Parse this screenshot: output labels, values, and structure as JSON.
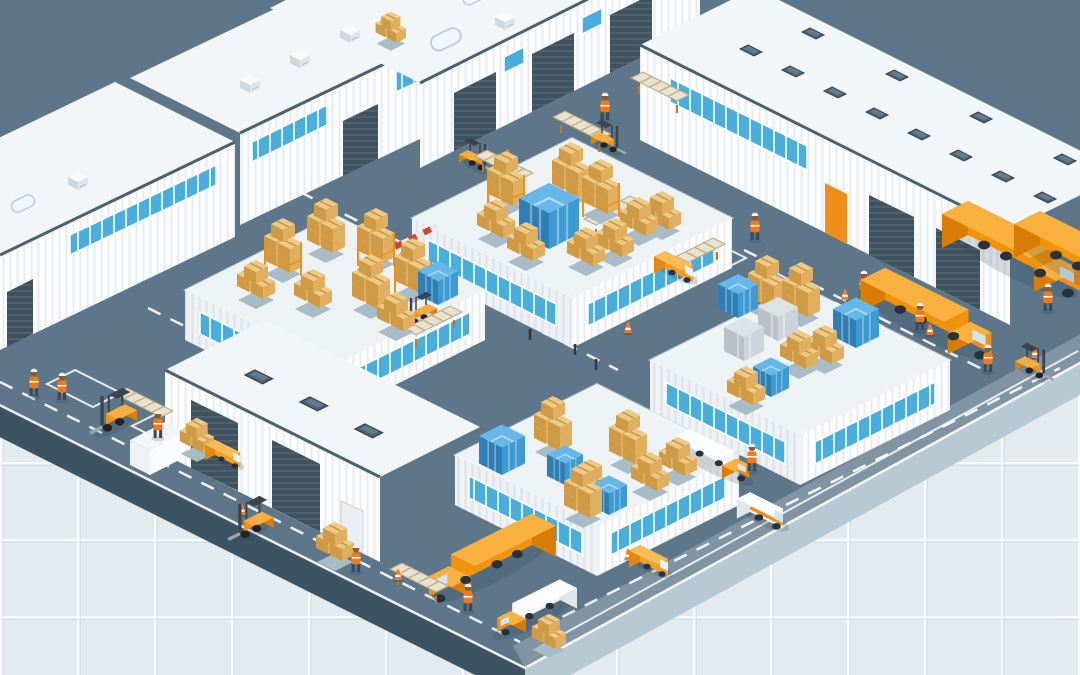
{
  "canvas": {
    "w": 1080,
    "h": 675
  },
  "scene": {
    "description": "Isometric illustration of a logistics park on a pale blue grid: white ribbed warehouse buildings with loading docks and rooftop units, four raised storage yards with blue-glazed walls stacked with tan carton pallets and blue or gray shrink-wrapped pallets, slate roads with white lane markings, orange semi trucks, white box trucks, small vans, forklifts with conveyor ramps, hi-vis workers and traffic cones.",
    "inventory": {
      "warehouse_buildings": 6,
      "storage_yards": 4,
      "orange_trucks": 4,
      "white_trucks": 2,
      "small_vans": 4,
      "forklifts": 6,
      "workers": 12,
      "traffic_cones": 8,
      "pallet_stacks": 42,
      "conveyor_ramps": 8,
      "roof_skylights": 15,
      "bollards": 3
    }
  },
  "palette": {
    "bg": "#e3ebee",
    "road": "#5d7689",
    "slab_left": "#3c5363",
    "slab_right": "#b7c9d3",
    "wall": "#fbfcfd",
    "wall_shade": "#eef2f5",
    "roof": "#f3f6f8",
    "trim": "#4a616f",
    "glass": "#49aede",
    "door": "#3f5260",
    "yard": "#edf2f5",
    "box_top": "#eec984",
    "box_side": "#dfaf5f",
    "box_dark": "#cf9a45",
    "box_tape": "#c89040",
    "wrap_blue_top": "#66b8e8",
    "wrap_blue": "#3d9ad2",
    "wrap_blue_dark": "#2f7fb5",
    "gray_top": "#dde2e6",
    "gray_side": "#cdd3d9",
    "gray_dark": "#b9c0c8",
    "truck_top": "#f8b13f",
    "truck_side": "#f0930c",
    "truck_dark": "#d97c06",
    "white_top": "#fbfdfe",
    "white_side": "#f4f7f9",
    "white_dark": "#dfe7ec",
    "accent": "#ef8f1a",
    "vest": "#f07818",
    "cone": "#f07d28",
    "wheel": "#27333c",
    "shadow": "rgba(40,60,75,0.18)",
    "marking": "#ffffff"
  },
  "sprites": [
    {
      "t": "sky",
      "x": 748,
      "y": 45
    },
    {
      "t": "sky",
      "x": 790,
      "y": 66
    },
    {
      "t": "sky",
      "x": 832,
      "y": 87
    },
    {
      "t": "sky",
      "x": 874,
      "y": 108
    },
    {
      "t": "sky",
      "x": 916,
      "y": 129
    },
    {
      "t": "sky",
      "x": 958,
      "y": 150
    },
    {
      "t": "sky",
      "x": 1000,
      "y": 171
    },
    {
      "t": "sky",
      "x": 1042,
      "y": 192
    },
    {
      "t": "sky",
      "x": 810,
      "y": 28
    },
    {
      "t": "sky",
      "x": 894,
      "y": 70
    },
    {
      "t": "sky",
      "x": 978,
      "y": 112
    },
    {
      "t": "sky",
      "x": 1062,
      "y": 154
    },
    {
      "t": "sky",
      "x": 255,
      "y": 370,
      "s": 1.25
    },
    {
      "t": "sky",
      "x": 310,
      "y": 397,
      "s": 1.25
    },
    {
      "t": "sky",
      "x": 365,
      "y": 424,
      "s": 1.25
    },
    {
      "t": "tank",
      "x": 30,
      "y": 218
    },
    {
      "t": "hvac",
      "x": 78,
      "y": 192
    },
    {
      "t": "hvac",
      "x": 250,
      "y": 95
    },
    {
      "t": "hvac",
      "x": 300,
      "y": 70
    },
    {
      "t": "hvac",
      "x": 350,
      "y": 45
    },
    {
      "t": "tan",
      "x": 390,
      "y": 42,
      "s": 0.8
    },
    {
      "t": "tank",
      "x": 455,
      "y": 58,
      "s": 1.3
    },
    {
      "t": "hvac",
      "x": 505,
      "y": 32
    },
    {
      "t": "tank",
      "x": 480,
      "y": 10,
      "s": 0.9
    },
    {
      "t": "hvac",
      "x": 558,
      "y": -2,
      "s": 0.9
    },
    {
      "t": "conv",
      "x": 475,
      "y": 162
    },
    {
      "t": "conv",
      "x": 553,
      "y": 123
    },
    {
      "t": "conv",
      "x": 631,
      "y": 84
    },
    {
      "t": "conv",
      "x": 642,
      "y": 208,
      "f": 1
    },
    {
      "t": "conv",
      "x": 725,
      "y": 250,
      "f": 1
    },
    {
      "t": "conv",
      "x": 462,
      "y": 318,
      "f": 1
    },
    {
      "t": "conv",
      "x": 115,
      "y": 400
    },
    {
      "t": "conv",
      "x": 390,
      "y": 575
    },
    {
      "t": "rack",
      "x": 505,
      "y": 205
    },
    {
      "t": "tanT",
      "x": 570,
      "y": 196
    },
    {
      "t": "rack",
      "x": 600,
      "y": 213
    },
    {
      "t": "tan",
      "x": 638,
      "y": 235
    },
    {
      "t": "blue",
      "x": 549,
      "y": 249,
      "s": 1.5
    },
    {
      "t": "tan",
      "x": 495,
      "y": 237
    },
    {
      "t": "tan",
      "x": 525,
      "y": 260
    },
    {
      "t": "tan",
      "x": 585,
      "y": 265
    },
    {
      "t": "tan",
      "x": 614,
      "y": 256
    },
    {
      "t": "tan",
      "x": 661,
      "y": 229
    },
    {
      "t": "rack",
      "x": 282,
      "y": 272
    },
    {
      "t": "rack",
      "x": 375,
      "y": 262
    },
    {
      "t": "rack",
      "x": 412,
      "y": 292
    },
    {
      "t": "blue",
      "x": 438,
      "y": 305
    },
    {
      "t": "tanT",
      "x": 325,
      "y": 252
    },
    {
      "t": "tanT",
      "x": 370,
      "y": 308
    },
    {
      "t": "tan",
      "x": 312,
      "y": 307
    },
    {
      "t": "tan",
      "x": 255,
      "y": 298
    },
    {
      "t": "tan",
      "x": 395,
      "y": 330
    },
    {
      "t": "blue",
      "x": 502,
      "y": 475,
      "s": 1.15
    },
    {
      "t": "tanT",
      "x": 552,
      "y": 450
    },
    {
      "t": "blue",
      "x": 565,
      "y": 485,
      "s": 0.9
    },
    {
      "t": "tan",
      "x": 589,
      "y": 497
    },
    {
      "t": "tanT",
      "x": 627,
      "y": 463
    },
    {
      "t": "tan",
      "x": 649,
      "y": 490
    },
    {
      "t": "tanT",
      "x": 582,
      "y": 517
    },
    {
      "t": "blue",
      "x": 609,
      "y": 515,
      "s": 0.9
    },
    {
      "t": "tan",
      "x": 677,
      "y": 475
    },
    {
      "t": "blue",
      "x": 738,
      "y": 318
    },
    {
      "t": "tanT",
      "x": 766,
      "y": 309
    },
    {
      "t": "gray",
      "x": 744,
      "y": 361
    },
    {
      "t": "gray",
      "x": 778,
      "y": 341
    },
    {
      "t": "tan",
      "x": 798,
      "y": 368
    },
    {
      "t": "tan",
      "x": 824,
      "y": 363
    },
    {
      "t": "blue",
      "x": 856,
      "y": 348,
      "s": 1.15
    },
    {
      "t": "tanT",
      "x": 800,
      "y": 316
    },
    {
      "t": "tan",
      "x": 745,
      "y": 404
    },
    {
      "t": "blue",
      "x": 771,
      "y": 397,
      "s": 0.9
    },
    {
      "t": "tan",
      "x": 334,
      "y": 560
    },
    {
      "t": "tan",
      "x": 548,
      "y": 648,
      "s": 0.9
    },
    {
      "t": "tan",
      "x": 196,
      "y": 452,
      "s": 0.9
    },
    {
      "t": "semi",
      "x": 968,
      "y": 235
    },
    {
      "t": "semi",
      "x": 1040,
      "y": 245
    },
    {
      "t": "semi",
      "x": 885,
      "y": 300,
      "s": 0.95
    },
    {
      "t": "semi",
      "x": 532,
      "y": 545,
      "s": 0.92,
      "f": 1
    },
    {
      "t": "wtruck",
      "x": 690,
      "y": 448,
      "s": 0.8
    },
    {
      "t": "wtruck",
      "x": 560,
      "y": 600,
      "s": 0.85,
      "f": 1
    },
    {
      "t": "van",
      "x": 750,
      "y": 512,
      "s": 1.1
    },
    {
      "t": "vanY",
      "x": 665,
      "y": 268
    },
    {
      "t": "vanY",
      "x": 640,
      "y": 562
    },
    {
      "t": "vanY",
      "x": 215,
      "y": 455,
      "s": 0.9
    },
    {
      "t": "fork",
      "x": 125,
      "y": 415,
      "s": 1.35,
      "f": 1
    },
    {
      "t": "fork",
      "x": 262,
      "y": 522,
      "s": 1.3,
      "f": 1
    },
    {
      "t": "fork",
      "x": 468,
      "y": 158
    },
    {
      "t": "fork",
      "x": 600,
      "y": 140
    },
    {
      "t": "fork",
      "x": 428,
      "y": 312,
      "f": 1
    },
    {
      "t": "fork",
      "x": 1025,
      "y": 365,
      "s": 1.1
    },
    {
      "t": "work",
      "x": 34,
      "y": 396,
      "s": 1.3
    },
    {
      "t": "work",
      "x": 62,
      "y": 400,
      "s": 1.3
    },
    {
      "t": "work",
      "x": 158,
      "y": 438,
      "s": 1.3
    },
    {
      "t": "work",
      "x": 356,
      "y": 572,
      "s": 1.3
    },
    {
      "t": "work",
      "x": 468,
      "y": 611,
      "s": 1.3
    },
    {
      "t": "work",
      "x": 605,
      "y": 120,
      "s": 1.3
    },
    {
      "t": "work",
      "x": 755,
      "y": 240,
      "s": 1.3
    },
    {
      "t": "work",
      "x": 864,
      "y": 298,
      "s": 1.3
    },
    {
      "t": "work",
      "x": 920,
      "y": 330,
      "s": 1.3
    },
    {
      "t": "work",
      "x": 988,
      "y": 372,
      "s": 1.3
    },
    {
      "t": "work",
      "x": 1048,
      "y": 311,
      "s": 1.3
    },
    {
      "t": "work",
      "x": 752,
      "y": 471,
      "s": 1.3
    },
    {
      "t": "cone",
      "x": 508,
      "y": 160,
      "s": 1.2
    },
    {
      "t": "cone",
      "x": 628,
      "y": 333,
      "s": 1.2
    },
    {
      "t": "cone",
      "x": 845,
      "y": 300,
      "s": 1.2
    },
    {
      "t": "cone",
      "x": 930,
      "y": 335,
      "s": 1.2
    },
    {
      "t": "cone",
      "x": 1035,
      "y": 358,
      "s": 1.2
    },
    {
      "t": "cone",
      "x": 242,
      "y": 515,
      "s": 1.2
    },
    {
      "t": "cone",
      "x": 628,
      "y": 560,
      "s": 1.2
    },
    {
      "t": "cone",
      "x": 398,
      "y": 580,
      "s": 1.2
    },
    {
      "t": "boll",
      "x": 530,
      "y": 340
    },
    {
      "t": "boll",
      "x": 575,
      "y": 355
    },
    {
      "t": "boll",
      "x": 596,
      "y": 370
    }
  ]
}
